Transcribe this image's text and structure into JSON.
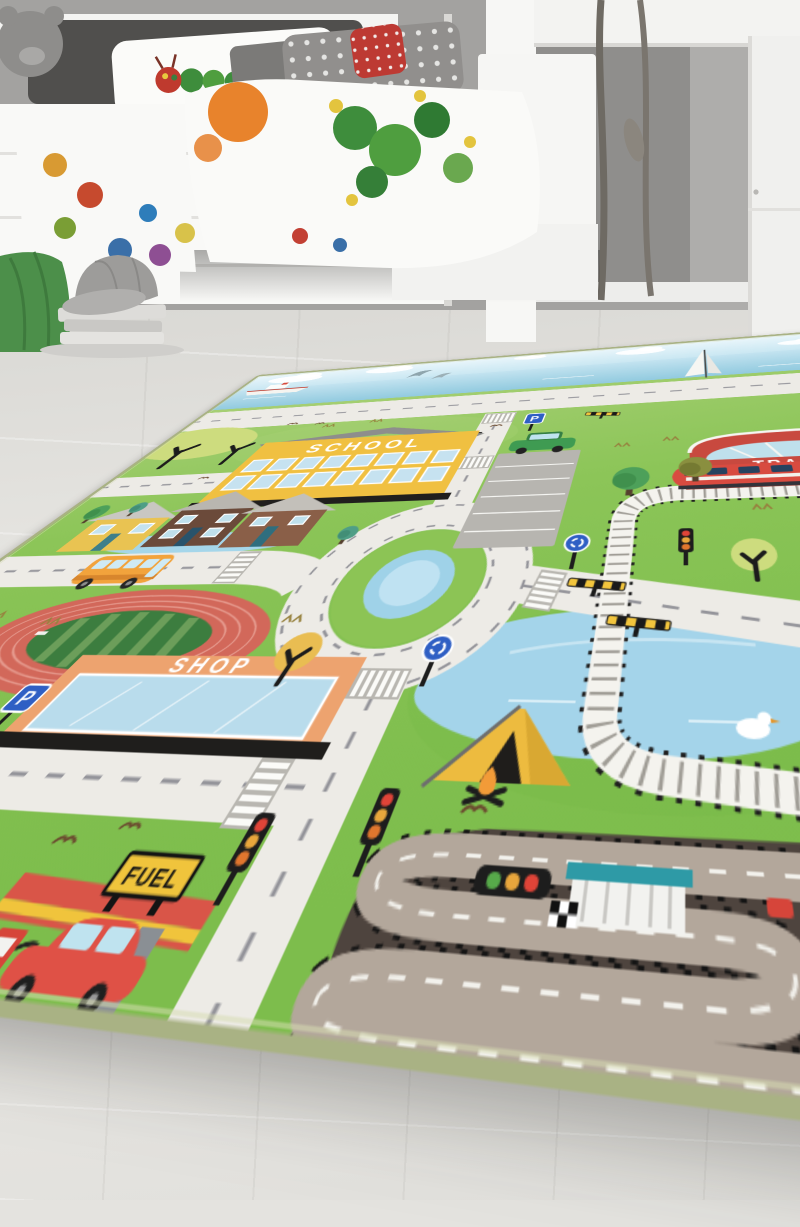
{
  "meta": {
    "alt": "Photo of a green city-traffic play rug lying on a light wooden floor in a children's bedroom with a white loft bed, caterpillar-print bedding, decorative branches and a white wardrobe"
  },
  "room": {
    "wall_color": "#a3a2a0",
    "floor_color": "#e4e3df",
    "objects": [
      "loft-bed",
      "plush-bear",
      "caterpillar-pillow",
      "polka-dot-pillow",
      "red-polka-pillow",
      "fruit-print-duvet",
      "teal-sheet",
      "footboard",
      "white-post",
      "white-beam",
      "wardrobe",
      "decor-branches",
      "green-knit-pouf",
      "baseball-cap",
      "book-stack"
    ]
  },
  "rug": {
    "theme": "city road play rug",
    "labels": {
      "school": "SCHOOL",
      "train": "TRAIN",
      "shop": "SHOP",
      "fuel": "FUEL",
      "parking": "P"
    },
    "palette": {
      "grass": "#8cc558",
      "road": "#edebe6",
      "dash": "#94949a",
      "sky": "#d8edf6",
      "sea": "#a6d4e8",
      "lake": "#a4d4ea",
      "rail": "#f4f3ee",
      "race_area": "#4e443e",
      "race_track": "#b3a79b",
      "track_red": "#d2685a",
      "infield_green": "#3c7d3f",
      "school_yellow": "#f0c041",
      "station_red": "#c8493f",
      "shop_orange": "#eda36f",
      "fuel_yellow": "#f0c43c",
      "bus_orange": "#f2a33c",
      "car_green": "#3f9b52",
      "car_red": "#df5146",
      "train_red": "#d84b40",
      "sign_blue": "#2f5fc4",
      "binding": "#a9b284"
    },
    "features": [
      "sea strip with ship, dolphins and sailboat",
      "coast road",
      "school",
      "parking lot with green car",
      "train station with red train",
      "railway loop with level crossing",
      "roundabout with pond",
      "three houses",
      "orange bus",
      "running track",
      "shop",
      "fuel station with red car",
      "race circuit with pit garage, start lights and checkered flag",
      "lake with duck",
      "tent and campfire",
      "traffic lights",
      "zebra crossings",
      "roundabout signs"
    ],
    "sprites": [
      {
        "t": "cloud",
        "x": 95,
        "y": 30,
        "s": 1.3
      },
      {
        "t": "cloud",
        "x": 270,
        "y": 22,
        "s": 1.1
      },
      {
        "t": "cloud",
        "x": 520,
        "y": 16,
        "s": 0.7
      },
      {
        "t": "cloud",
        "x": 705,
        "y": 26,
        "s": 1
      },
      {
        "t": "cloud",
        "x": 948,
        "y": 36,
        "s": 0.8
      },
      {
        "t": "tree-round",
        "x": 718,
        "y": 366,
        "s": 1.2
      },
      {
        "t": "tree-round",
        "x": 50,
        "y": 388,
        "s": 0.8
      },
      {
        "t": "tree-olive",
        "x": 788,
        "y": 350,
        "s": 1.15
      },
      {
        "t": "tree-teal",
        "x": 104,
        "y": 380,
        "s": 0.85
      },
      {
        "t": "tree-teal",
        "x": 420,
        "y": 438,
        "s": 0.9
      },
      {
        "t": "tree-cy",
        "x": 838,
        "y": 492,
        "s": 1
      },
      {
        "t": "tree-co",
        "x": 455,
        "y": 594,
        "s": 1
      },
      {
        "t": "bird",
        "x": 195,
        "y": 190,
        "s": 1
      },
      {
        "t": "bird",
        "x": 242,
        "y": 194,
        "s": 0.9
      },
      {
        "t": "bird",
        "x": 525,
        "y": 230,
        "s": 1
      },
      {
        "t": "bird",
        "x": 150,
        "y": 320,
        "s": 0.9
      },
      {
        "t": "bird",
        "x": 378,
        "y": 722,
        "s": 1
      },
      {
        "t": "bird",
        "x": 418,
        "y": 712,
        "s": 0.9
      },
      {
        "t": "bird",
        "x": 648,
        "y": 692,
        "s": 1
      },
      {
        "t": "tuft",
        "x": 262,
        "y": 206,
        "s": 1
      },
      {
        "t": "tuft",
        "x": 334,
        "y": 200,
        "s": 1
      },
      {
        "t": "tuft",
        "x": 702,
        "y": 296,
        "s": 1
      },
      {
        "t": "tuft",
        "x": 760,
        "y": 288,
        "s": 1
      },
      {
        "t": "tuft",
        "x": 852,
        "y": 418,
        "s": 1
      },
      {
        "t": "tuft",
        "x": 920,
        "y": 406,
        "s": 1
      },
      {
        "t": "tuft",
        "x": 878,
        "y": 566,
        "s": 1
      },
      {
        "t": "tuft",
        "x": 940,
        "y": 556,
        "s": 1
      },
      {
        "t": "tuft",
        "x": 96,
        "y": 544,
        "s": 1
      },
      {
        "t": "tuft",
        "x": 170,
        "y": 552,
        "s": 1
      },
      {
        "t": "tuft",
        "x": 428,
        "y": 550,
        "s": 1
      },
      {
        "t": "tuft",
        "x": 962,
        "y": 694,
        "s": 1
      },
      {
        "t": "rsign",
        "x": 578,
        "y": 586,
        "s": 1
      },
      {
        "t": "rsign",
        "x": 674,
        "y": 468,
        "s": 1
      },
      {
        "t": "tlight",
        "x": 510,
        "y": 718,
        "s": 1
      },
      {
        "t": "tlight",
        "x": 588,
        "y": 700,
        "s": 1
      },
      {
        "t": "tlight",
        "x": 778,
        "y": 460,
        "s": 1
      },
      {
        "t": "barrier",
        "x": 700,
        "y": 511,
        "s": 1
      },
      {
        "t": "barrier",
        "x": 740,
        "y": 552,
        "s": 1
      },
      {
        "t": "barrier",
        "x": 668,
        "y": 216,
        "s": 0.9
      }
    ]
  }
}
